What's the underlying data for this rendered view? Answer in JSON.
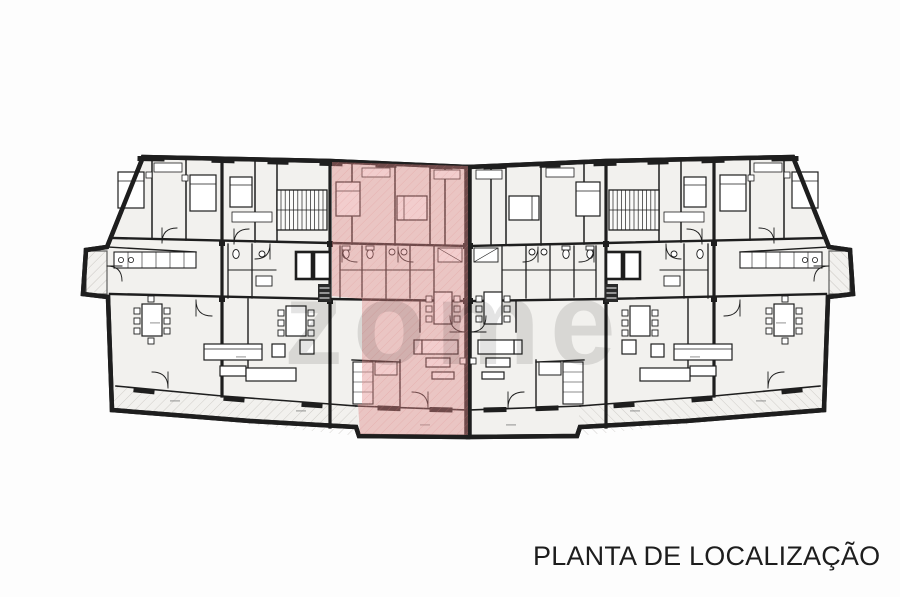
{
  "page": {
    "background_color": "#fdfdfd"
  },
  "title": {
    "text": "PLANTA DE LOCALIZAÇÃO"
  },
  "watermark": {
    "text": "zome"
  },
  "plan": {
    "kind": "architectural location floor plan, scanned drawing",
    "highlighted_unit": "central apartment with balcony, tinted pink",
    "colors": {
      "walls": "#1e1e1e",
      "floor": "#f2f1ee",
      "balcony_hatch": "#b9b5b0",
      "highlight": "#e08888",
      "highlight_hatch": "#d98080",
      "paper": "#fdfdfd"
    }
  }
}
